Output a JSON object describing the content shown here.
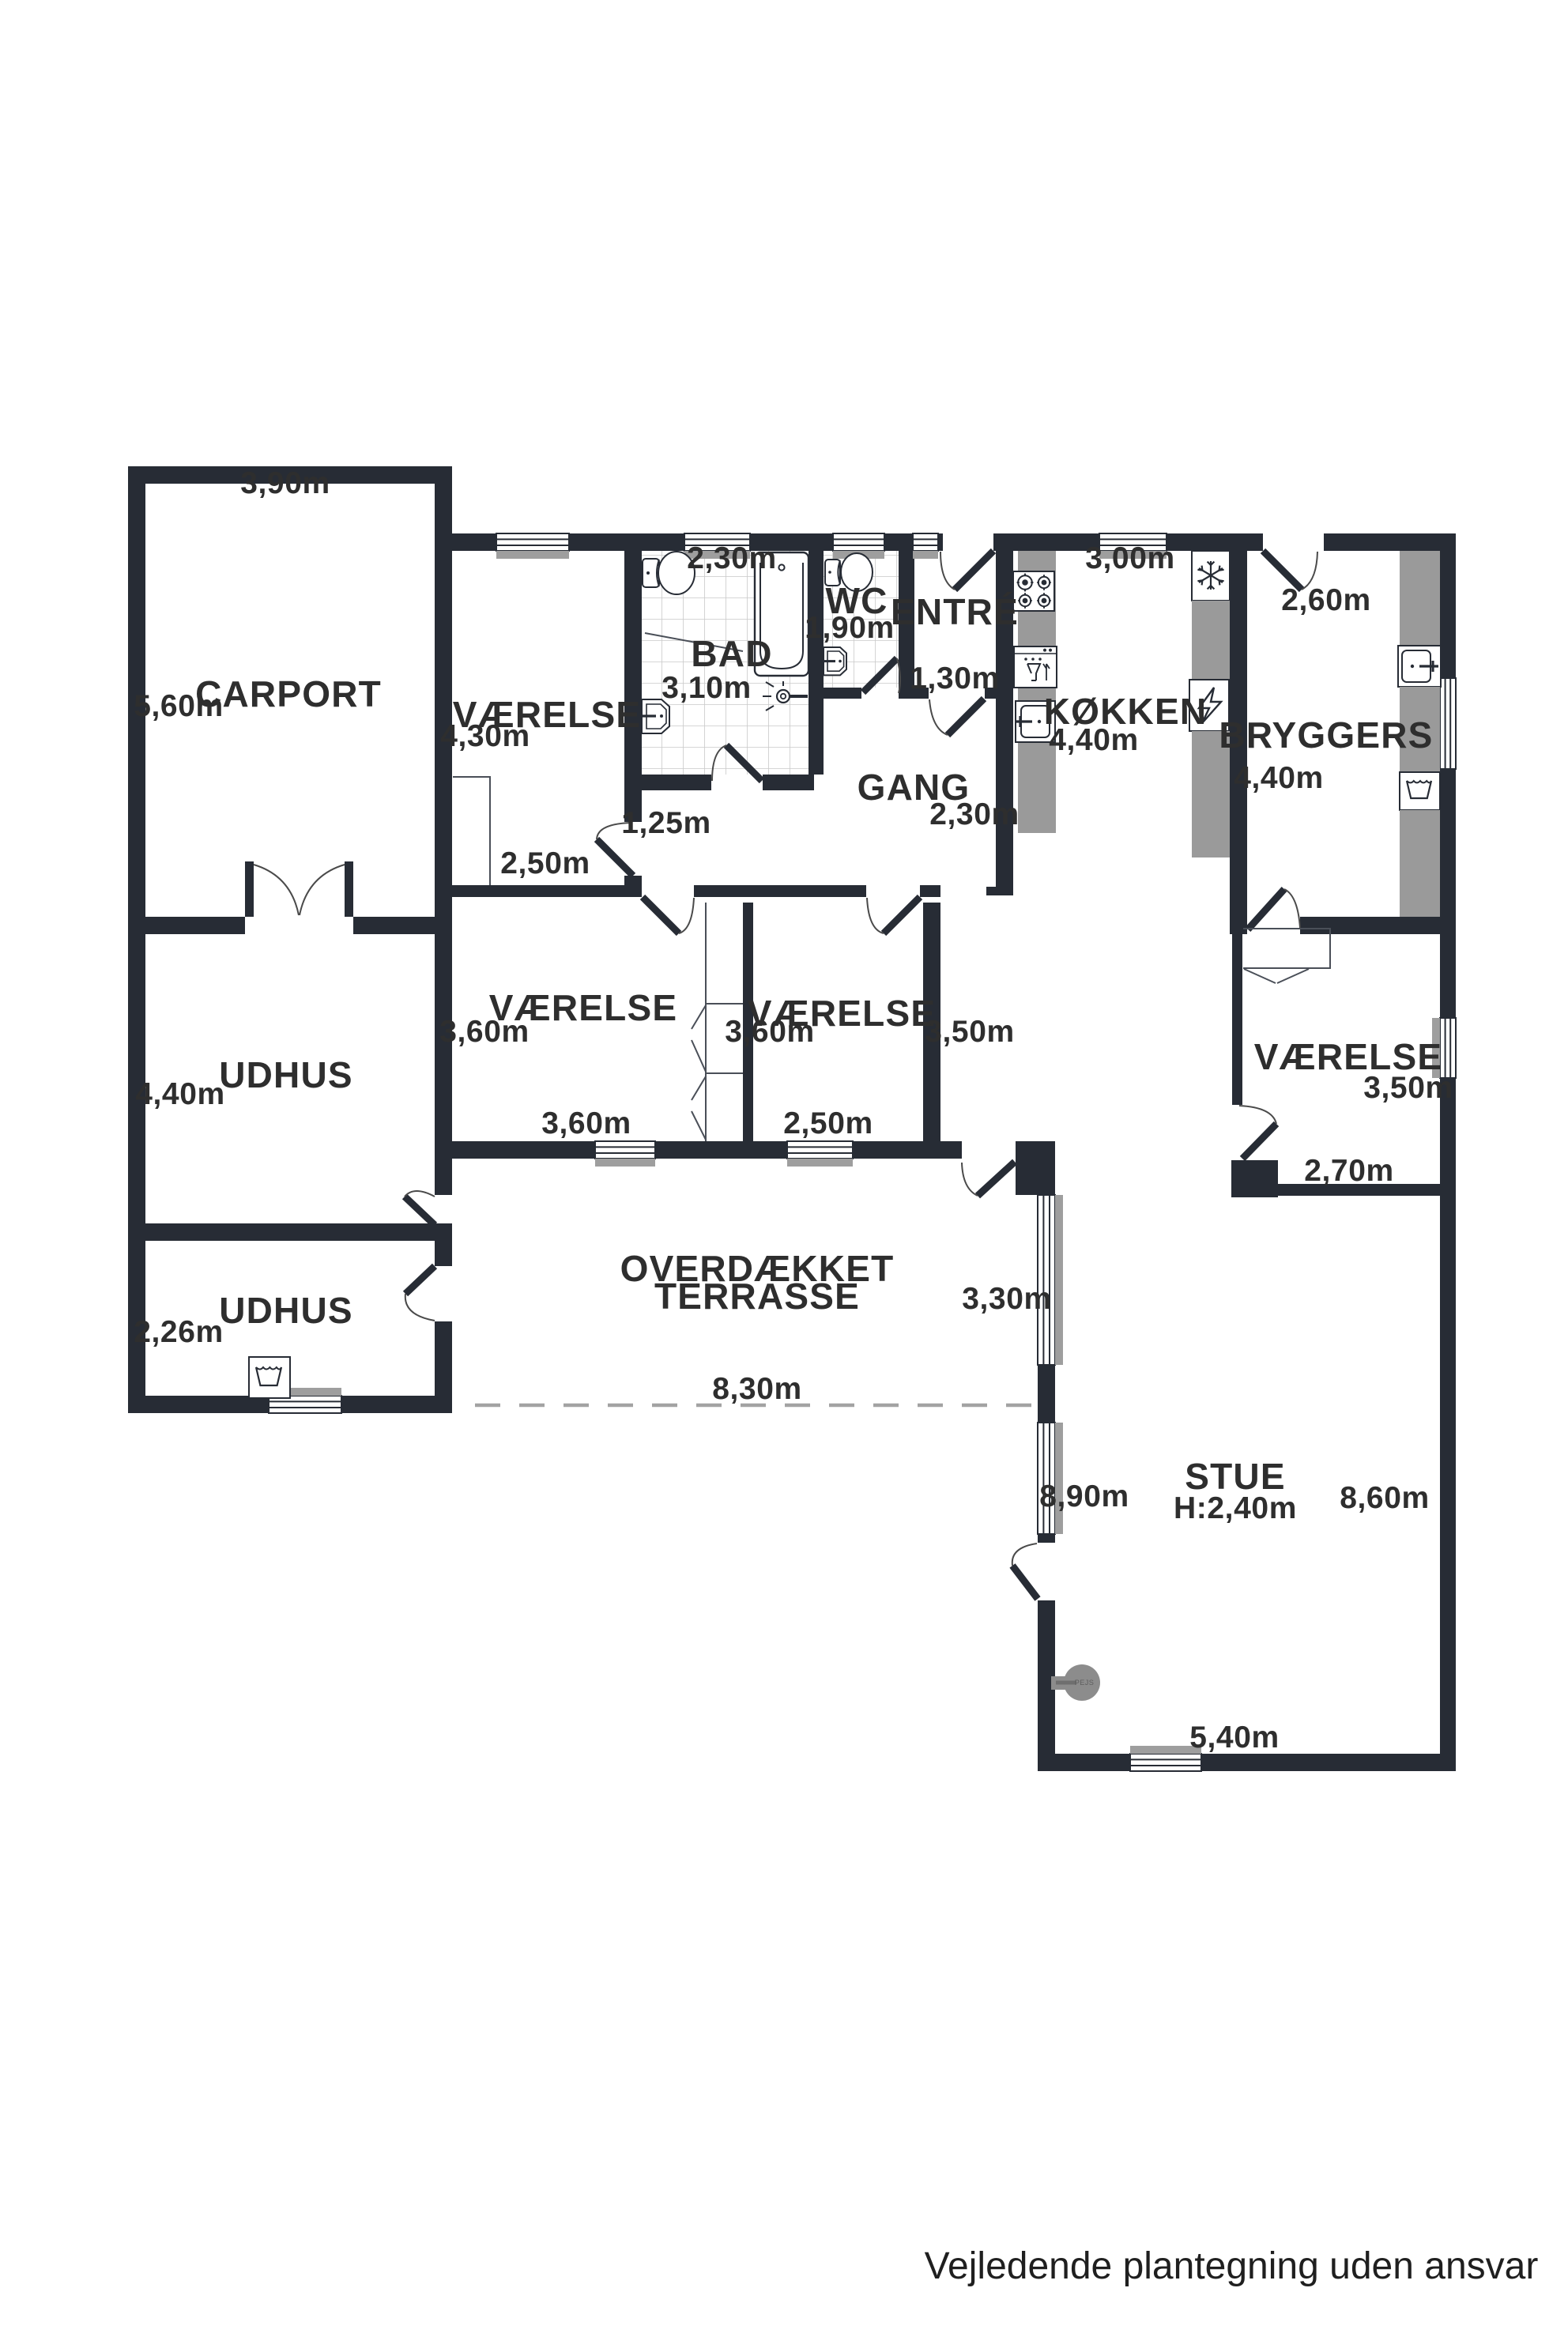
{
  "page": {
    "footer": "Vejledende plantegning uden ansvar"
  },
  "colors": {
    "wall": "#272c35",
    "counter_gray": "#9a9a9a",
    "sill_gray": "#9e9e9e",
    "tile_line": "#c9c9c9",
    "fireplace_gray": "#8c8c8c",
    "dash_gray": "#a3a3a3",
    "text": "#2e2e2e"
  },
  "rooms": {
    "carport": {
      "name": "CARPORT",
      "w": "3,90m",
      "h": "5,60m"
    },
    "udhus_top": {
      "name": "UDHUS",
      "h": "4,40m"
    },
    "udhus_bottom": {
      "name": "UDHUS",
      "h": "2,26m"
    },
    "vaerelse_nw": {
      "name": "VÆRELSE",
      "h": "4,30m",
      "w": "2,50m"
    },
    "bad": {
      "name": "BAD",
      "w": "2,30m",
      "h": "3,10m"
    },
    "wc": {
      "name": "WC",
      "w": "1,90m"
    },
    "entre": {
      "name": "ENTRÉ",
      "w": "1,30m"
    },
    "gang": {
      "name": "GANG",
      "w": "2,30m",
      "stub_w": "1,25m"
    },
    "koekken": {
      "name": "KØKKEN",
      "w": "3,00m",
      "h": "4,40m"
    },
    "bryggers": {
      "name": "BRYGGERS",
      "w": "2,60m",
      "h": "4,40m"
    },
    "vaerelse_mid_left": {
      "name": "VÆRELSE",
      "h": "3,60m",
      "w": "3,60m"
    },
    "vaerelse_mid_right": {
      "name": "VÆRELSE",
      "h": "3,60m",
      "w": "2,50m"
    },
    "hall": {
      "h": "3,50m"
    },
    "vaerelse_east": {
      "name": "VÆRELSE",
      "h": "3,50m",
      "w": "2,70m"
    },
    "terrasse": {
      "name_line1": "OVERDÆKKET",
      "name_line2": "TERRASSE",
      "h": "3,30m",
      "w": "8,30m"
    },
    "stue": {
      "name": "STUE",
      "ceiling": "H:2,40m",
      "dim_left": "8,90m",
      "dim_right": "8,60m",
      "dim_bottom": "5,40m"
    },
    "pejs": {
      "name": "PEJS"
    }
  }
}
